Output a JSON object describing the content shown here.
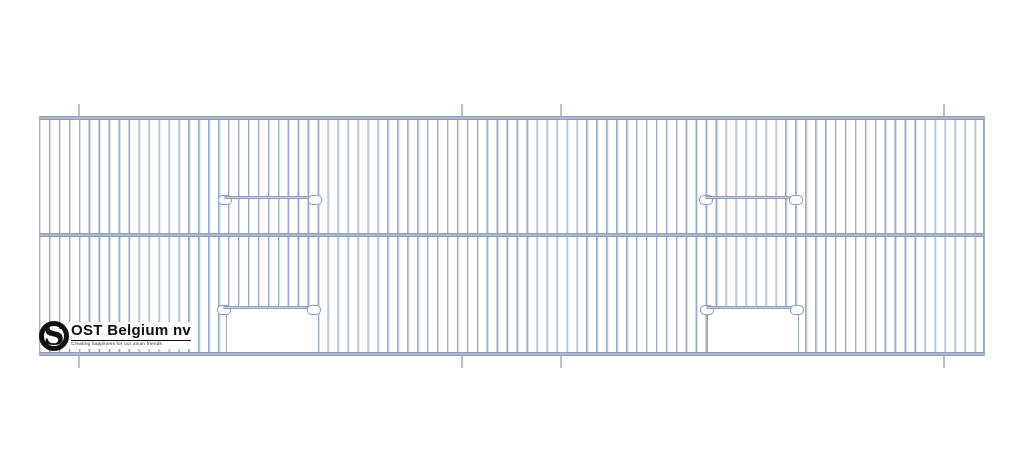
{
  "logo": {
    "name": "OST Belgium nv",
    "tagline": "Creating happiness for our avian friends",
    "monogram": "S"
  },
  "drawing": {
    "subject": "wire cage front panel technical drawing",
    "rows": 2,
    "door_bars": 4,
    "door_openings": 2,
    "fold_marks_top": 4,
    "fold_marks_bottom": 4
  },
  "colors": {
    "background": "#ffffff",
    "wire": "#9dabc4",
    "wire_highlight": "#dbe0e9",
    "rail": "#8f9eba",
    "fold_mark": "#b7c1d3",
    "logo_black": "#111111"
  }
}
